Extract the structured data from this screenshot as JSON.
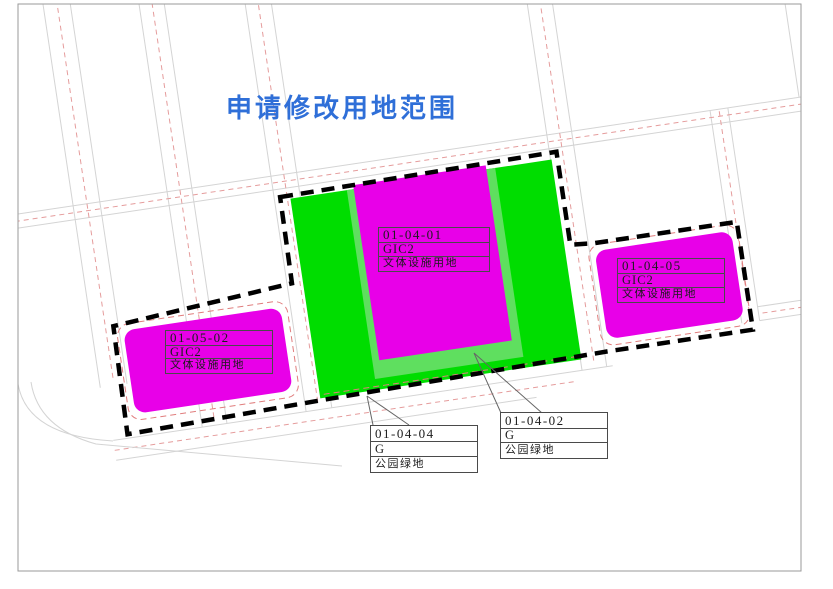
{
  "title": {
    "text": "申请修改用地范围"
  },
  "colors": {
    "title_blue": "#2f6fd8",
    "parcel_magenta": "#e800e8",
    "park_green": "#00dd00",
    "park_green_light": "#5fdf5f",
    "boundary_black": "#000000",
    "setback_red": "#e07d7d",
    "road_centerline_red": "#e59c9c",
    "road_gray": "#d4d4d4",
    "frame_gray": "#9a9a9a"
  },
  "labels": {
    "center": {
      "code": "01-04-01",
      "class_code": "GIC2",
      "land_use": "文体设施用地"
    },
    "left": {
      "code": "01-05-02",
      "class_code": "GIC2",
      "land_use": "文体设施用地"
    },
    "right": {
      "code": "01-04-05",
      "class_code": "GIC2",
      "land_use": "文体设施用地"
    },
    "park_left": {
      "code": "01-04-04",
      "class_code": "G",
      "land_use": "公园绿地"
    },
    "park_right": {
      "code": "01-04-02",
      "class_code": "G",
      "land_use": "公园绿地"
    }
  }
}
